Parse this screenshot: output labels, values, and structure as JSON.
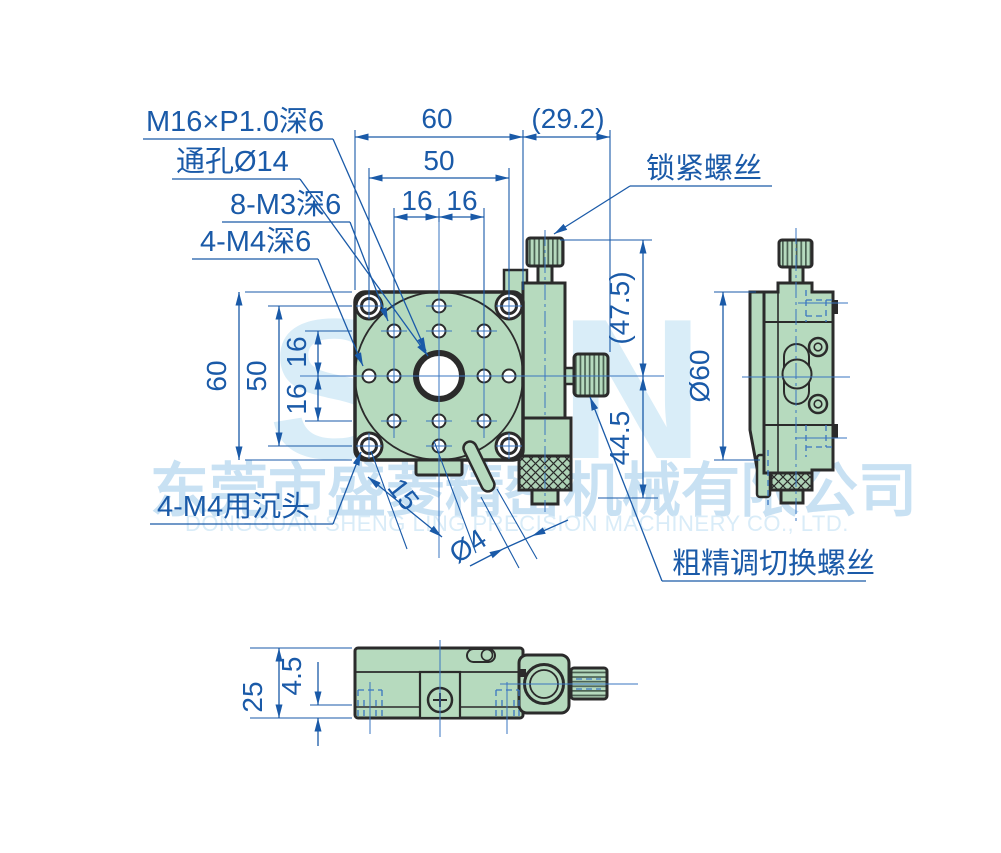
{
  "watermark": {
    "logo": "SLN",
    "company_cn": "东莞市盛菱精密机械有限公司",
    "company_en": "DONGGUAN SHENG LING PRECISION MACHINERY CO., LTD."
  },
  "callouts": {
    "center_thread": "M16×P1.0深6",
    "through_hole": "通孔Ø14",
    "m3_holes": "8-M3深6",
    "m4_holes": "4-M4深6",
    "m4_counterbore": "4-M4用沉头",
    "lock_screw": "锁紧螺丝",
    "coarse_fine_switch": "粗精调切换螺丝"
  },
  "dims": {
    "top_width": "60",
    "top_inner": "50",
    "pitch_a": "16",
    "pitch_b": "16",
    "offset": "(29.2)",
    "left_height": "60",
    "left_inner": "50",
    "vpitch_a": "16",
    "vpitch_b": "16",
    "knob_height": "(47.5)",
    "body_height": "44.5",
    "side_dia": "Ø60",
    "lever_len": "15",
    "lever_dia": "Ø4",
    "bottom_height": "25",
    "bottom_step": "4.5"
  },
  "colors": {
    "dim_blue": "#1a5aa8",
    "body_green": "#b6dabe",
    "outline": "#2b2b2b",
    "watermark_letters": "#d9edf8",
    "watermark_cn": "#c8e1f3",
    "watermark_en": "#d9ecf8"
  }
}
